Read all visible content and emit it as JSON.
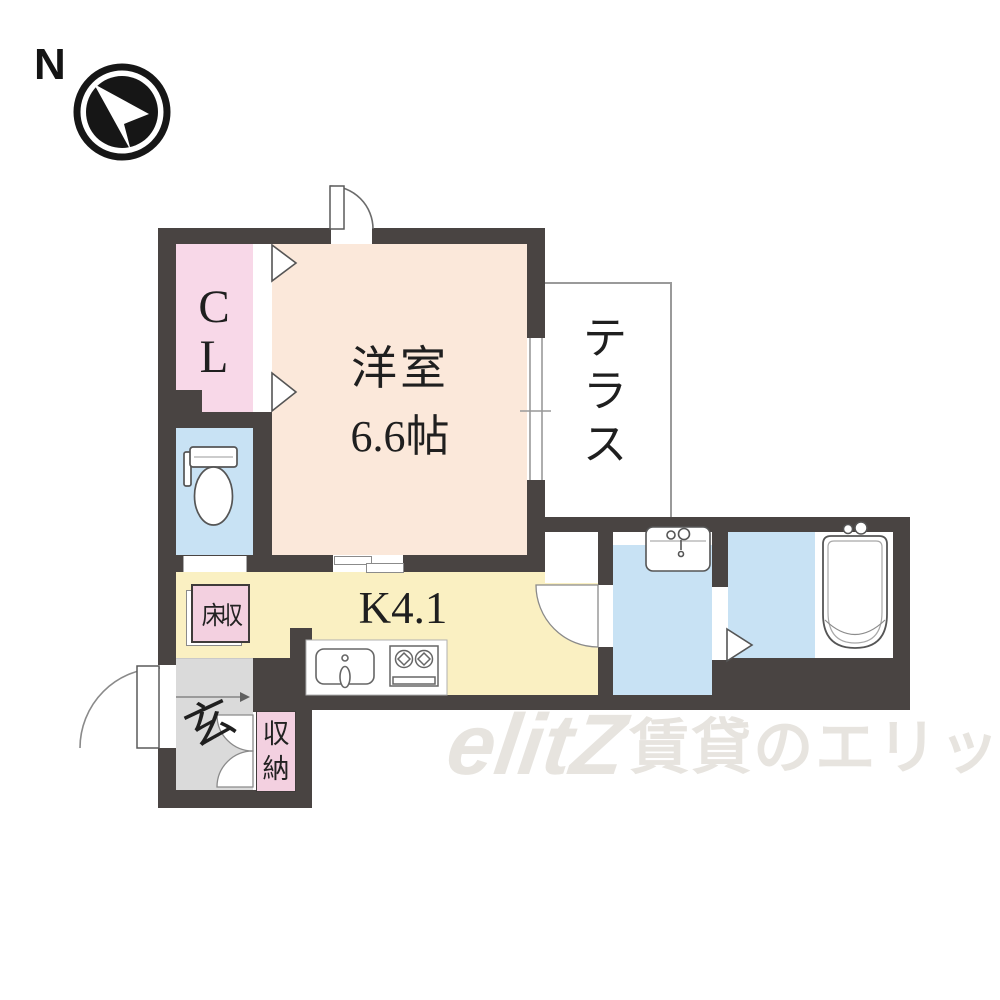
{
  "compass": {
    "north_label": "N"
  },
  "rooms": {
    "closet": {
      "line1": "C",
      "line2": "L"
    },
    "western_room": {
      "name": "洋室",
      "size": "6.6帖"
    },
    "terrace": {
      "chars": [
        "テ",
        "ラ",
        "ス"
      ]
    },
    "kitchen": {
      "label": "K4.1"
    },
    "floor_storage": {
      "label": "床収"
    },
    "entrance": {
      "label": "玄"
    },
    "storage": {
      "chars": [
        "収",
        "納"
      ]
    }
  },
  "watermark": {
    "logo": "elitZ",
    "text": "賃貸のエリッツ"
  },
  "colors": {
    "wall": "#494442",
    "room_peach": "#fbe8da",
    "closet_pink": "#f8d8e8",
    "label_pink": "#f3d0e0",
    "water_blue": "#c8e2f4",
    "kitchen_yellow": "#faf0c2",
    "entrance_gray": "#dadada"
  }
}
